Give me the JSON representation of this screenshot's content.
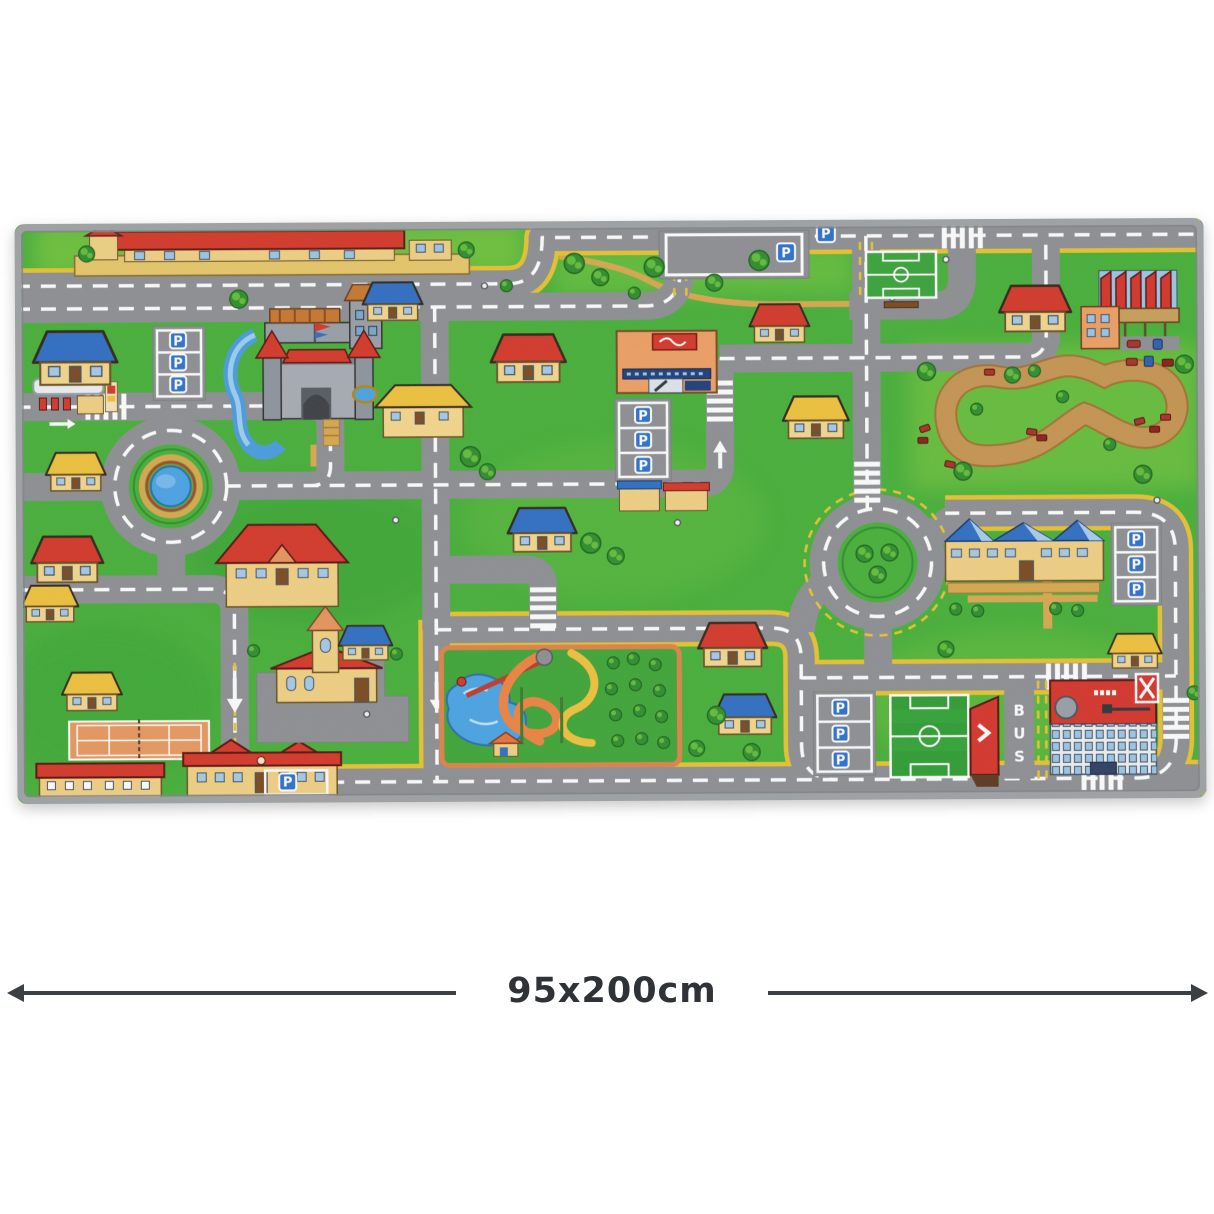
{
  "product_image": {
    "alt": "Top view photo of a children's city road play rug with roads, roundabouts, castle, race track, water park and sports fields",
    "dimension_annotation": {
      "label": "95x200cm"
    },
    "rug": {
      "labels": {
        "parking_sign": "P",
        "bus_lane_letters": [
          "B",
          "U",
          "S"
        ]
      },
      "features": [
        "train-station",
        "parking-lots",
        "castle-with-moat",
        "gas-station",
        "pond-roundabout",
        "tree-roundabout",
        "supermarket",
        "factory",
        "dirt-race-track",
        "water-park-with-slides",
        "small-soccer-field",
        "large-soccer-field",
        "grandstand",
        "tennis-court",
        "church",
        "school",
        "bus-lane",
        "stadium-building",
        "houses",
        "trees"
      ],
      "colors": {
        "rug_edge": "#9fa2a4",
        "grass": "#47b139",
        "grass_light": "#7cc83e",
        "grass_dark": "#2f9e33",
        "road": "#8e9093",
        "road_marking": "#ffffff",
        "yellow_marking": "#e9c42f",
        "sand_path": "#d9a94e",
        "water": "#4aa4e4",
        "dirt_track": "#c79551",
        "roof_red": "#d63829",
        "roof_blue": "#2f6fc4",
        "roof_yellow": "#f0c33c",
        "wall_tan": "#f2d183",
        "stone_gray": "#9aa0a8",
        "sign_blue": "#2d72cc",
        "field_green": "#2f9e33",
        "court_orange": "#e8995f",
        "stand_red": "#d7352a"
      }
    },
    "annotation_color": "#3b4045"
  }
}
